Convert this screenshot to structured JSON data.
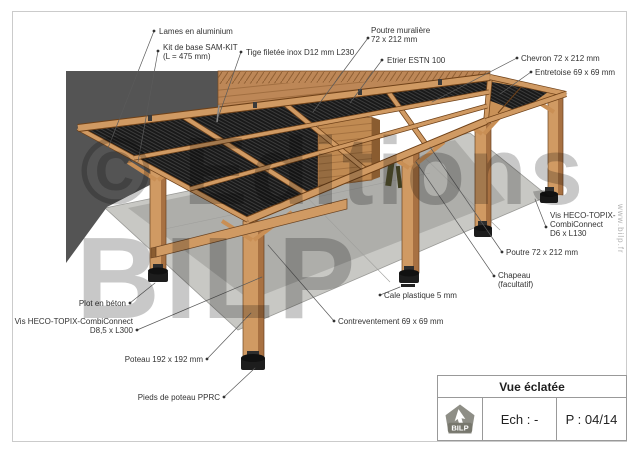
{
  "watermark": {
    "line1": "© Editions",
    "line2": "BILP",
    "website": "www.bilp.fr"
  },
  "title_block": {
    "title": "Vue éclatée",
    "scale_label": "Ech : -",
    "page_label": "P : 04/14",
    "logo_text": "BILP"
  },
  "callouts": [
    {
      "id": "lames",
      "lines": [
        "Lames en aluminium"
      ]
    },
    {
      "id": "kit-sam",
      "lines": [
        "Kit de base SAM-KIT",
        "(L = 475 mm)"
      ]
    },
    {
      "id": "tige",
      "lines": [
        "Tige filetée inox D12 mm L230"
      ]
    },
    {
      "id": "poutre-muraliere",
      "lines": [
        "Poutre muralière",
        "72 x 212 mm"
      ]
    },
    {
      "id": "etrier",
      "lines": [
        "Etrier ESTN 100"
      ]
    },
    {
      "id": "chevron",
      "lines": [
        "Chevron 72 x 212 mm"
      ]
    },
    {
      "id": "entretoise",
      "lines": [
        "Entretoise 69 x 69 mm"
      ]
    },
    {
      "id": "vis-d6",
      "lines": [
        "Vis HECO-TOPIX-",
        "CombiConnect",
        "D6 x L130"
      ]
    },
    {
      "id": "poutre",
      "lines": [
        "Poutre 72 x 212 mm"
      ]
    },
    {
      "id": "chapeau",
      "lines": [
        "Chapeau",
        "(facultatif)"
      ]
    },
    {
      "id": "cale",
      "lines": [
        "Cale plastique 5 mm"
      ]
    },
    {
      "id": "contreventement",
      "lines": [
        "Contreventement 69 x 69 mm"
      ]
    },
    {
      "id": "plot",
      "lines": [
        "Plot en béton"
      ]
    },
    {
      "id": "vis-d85",
      "lines": [
        "Vis HECO-TOPIX-CombiConnect",
        "D8,5 x L300"
      ]
    },
    {
      "id": "poteau",
      "lines": [
        "Poteau 192 x 192 mm"
      ]
    },
    {
      "id": "pieds",
      "lines": [
        "Pieds de poteau PPRC"
      ]
    }
  ],
  "colors": {
    "wood": "#d09a63",
    "wood_edge": "#6b4423",
    "wood_shade": "#a87142",
    "siding": "#bd8757",
    "wall_dark": "#545454",
    "slats": "#191919",
    "slab": "#c8c8c4",
    "slab_shadow": "#00000022",
    "leader": "#5a5a5a",
    "page_border": "#cbcbcb",
    "logo_gray": "#8e8e86",
    "label_text": "#333333"
  }
}
